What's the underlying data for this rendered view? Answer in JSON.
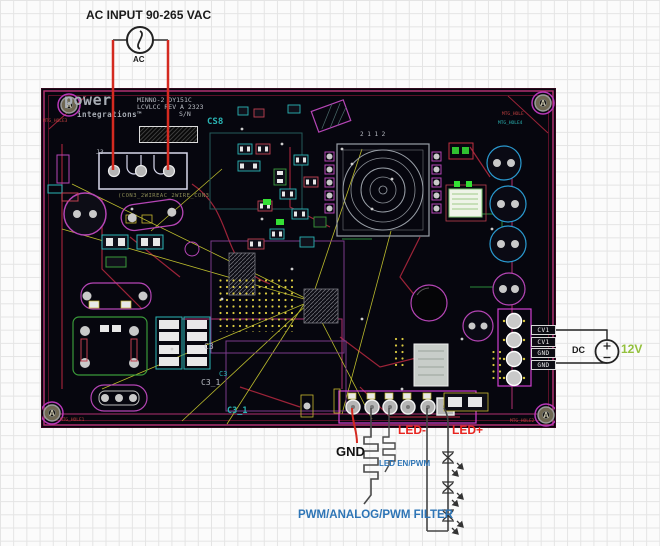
{
  "annotations": {
    "ac_title": "AC INPUT 90-265 VAC",
    "ac_source_label": "AC",
    "dc_source_label": "DC",
    "dc_voltage": "12V",
    "gnd": "GND",
    "led_en_pwm": "LED EN/PWM",
    "pwm_filter": "PWM/ANALOG/PWM FILTER",
    "led_minus": "LED-",
    "led_plus": "LED+"
  },
  "board": {
    "silkscreen": {
      "logo_line1": "power",
      "logo_line2": "integrations™",
      "model_line1": "MINNO-2 DY151C",
      "model_line2": "LCVLCC  REV A 2323",
      "model_line3": "S/N",
      "ref_cs": "CS8",
      "ref_j3": "J3",
      "ref_con3": "(CON3_2WIREAC_2WIRE_CON3",
      "ref_c3": "C3",
      "ref_c3_net": "C3",
      "ref_c3_1": "C3_1",
      "ref_c3_1_net": "C3_1",
      "transformer_pins": "2 1 1 2",
      "mtg_tl": "MTG_HOLE3",
      "mtg_tr_red": "MTG_HOLE",
      "mtg_tr_teal": "MTG_HOLE4",
      "mtg_bl": "MTG_HOLE1",
      "mtg_br": "MTG_HOLE2",
      "hole_letter": "A"
    },
    "edge_pins": [
      "CV1",
      "CV1",
      "GND",
      "GND"
    ]
  },
  "colors": {
    "wire_red": "#d42a20",
    "label_blue": "#2e75b6",
    "label_red": "#e8241f",
    "voltage_green": "#94c13d",
    "board_magenta": "#b03070",
    "silkscreen_gray": "#9aa0a8",
    "teal": "#2ab5b5",
    "ratsnest_yellow": "#cfcf30"
  }
}
